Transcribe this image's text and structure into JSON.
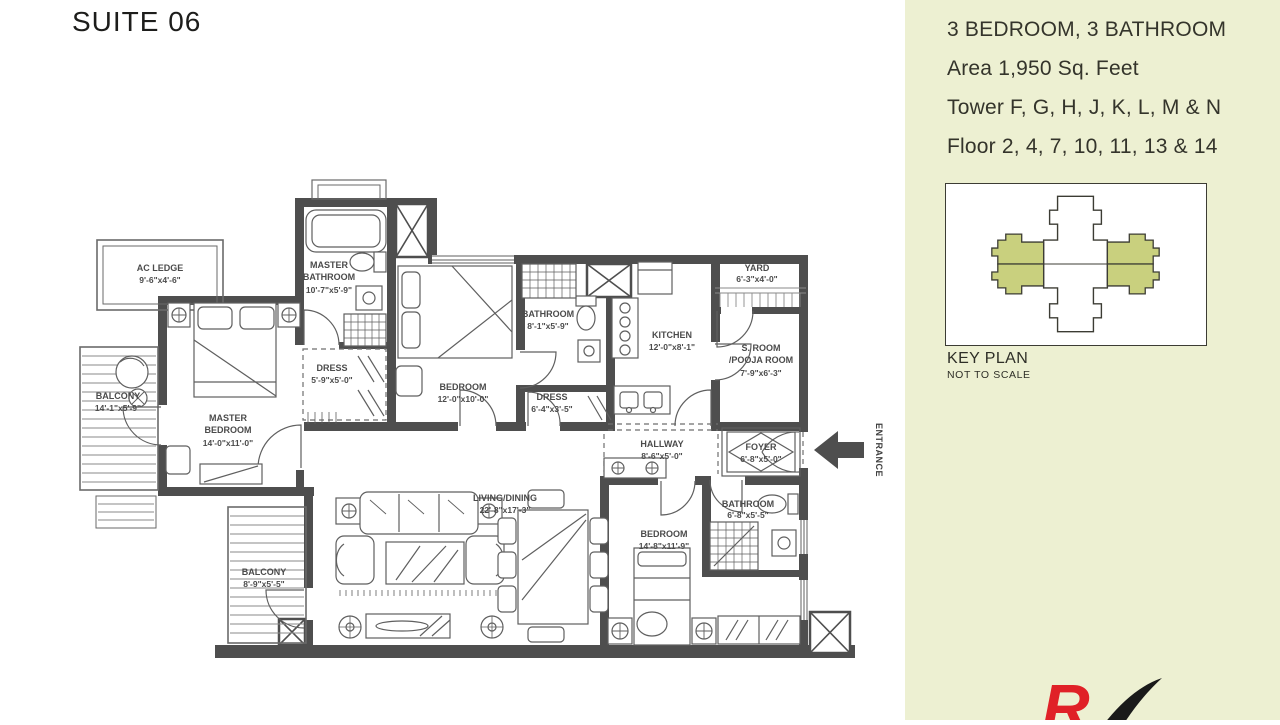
{
  "page": {
    "title": "SUITE 06"
  },
  "info_panel": {
    "specs": [
      "3 BEDROOM, 3 BATHROOM",
      "Area 1,950 Sq. Feet",
      "Tower F, G, H, J, K, L, M & N",
      "Floor 2, 4, 7, 10, 11, 13 & 14"
    ],
    "key_plan_title": "KEY PLAN",
    "key_plan_subtitle": "NOT TO SCALE",
    "colors": {
      "panel_bg": "#edf0d2",
      "keyplan_highlight": "#c9d07e",
      "logo_red": "#e02127",
      "logo_black": "#1a1a1a"
    }
  },
  "floor_plan": {
    "entrance_label": "ENTRANCE",
    "colors": {
      "wall": "#4e4e4e",
      "line": "#5f5f5f",
      "label": "#4b4b4b"
    },
    "rooms": {
      "ac_ledge": {
        "name": "AC LEDGE",
        "dims": "9'-6\"x4'-6\""
      },
      "balcony_1": {
        "name": "BALCONY",
        "dims": "14'-1\"x5'-9\""
      },
      "master_bedroom": {
        "name1": "MASTER",
        "name2": "BEDROOM",
        "dims": "14'-0\"x11'-0\""
      },
      "master_bathroom": {
        "name1": "MASTER",
        "name2": "BATHROOM",
        "dims": "10'-7\"x5'-9\""
      },
      "dress_1": {
        "name": "DRESS",
        "dims": "5'-9\"x5'-0\""
      },
      "bedroom_2": {
        "name": "BEDROOM",
        "dims": "12'-0\"x10'-0\""
      },
      "bathroom_2": {
        "name": "BATHROOM",
        "dims": "8'-1\"x5'-9\""
      },
      "dress_2": {
        "name": "DRESS",
        "dims": "6'-4\"x3'-5\""
      },
      "kitchen": {
        "name": "KITCHEN",
        "dims": "12'-0\"x8'-1\""
      },
      "yard": {
        "name": "YARD",
        "dims": "6'-3\"x4'-0\""
      },
      "pooja_room": {
        "name1": "S. ROOM",
        "name2": "/POOJA ROOM",
        "dims": "7'-9\"x6'-3\""
      },
      "hallway": {
        "name": "HALLWAY",
        "dims": "8'-6\"x5'-0\""
      },
      "foyer": {
        "name": "FOYER",
        "dims": "6'-8\"x5'-0\""
      },
      "living_dining": {
        "name": "LIVING/DINING",
        "dims": "22'-8\"x17'-3\""
      },
      "bedroom_3": {
        "name": "BEDROOM",
        "dims": "14'-8\"x11'-9\""
      },
      "bathroom_3": {
        "name": "BATHROOM",
        "dims": "6'-8\"x5'-5\""
      },
      "balcony_2": {
        "name": "BALCONY",
        "dims": "8'-9\"x5'-5\""
      }
    }
  }
}
